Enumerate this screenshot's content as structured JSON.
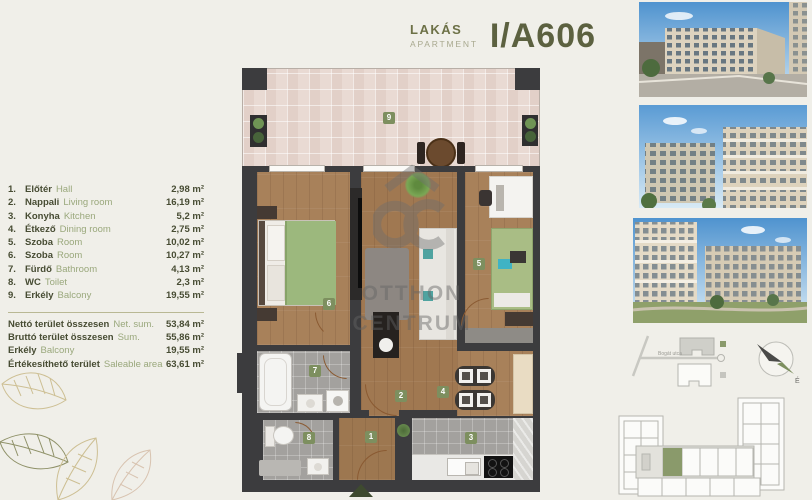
{
  "header": {
    "label_hu": "LAKÁS",
    "label_en": "APARTMENT",
    "unit": "I/A606"
  },
  "legend": {
    "rooms": [
      {
        "num": "1.",
        "name_hu": "Előtér",
        "name_en": "Hall",
        "area": "2,98 m²"
      },
      {
        "num": "2.",
        "name_hu": "Nappali",
        "name_en": "Living room",
        "area": "16,19 m²"
      },
      {
        "num": "3.",
        "name_hu": "Konyha",
        "name_en": "Kitchen",
        "area": "5,2 m²"
      },
      {
        "num": "4.",
        "name_hu": "Étkező",
        "name_en": "Dining room",
        "area": "2,75 m²"
      },
      {
        "num": "5.",
        "name_hu": "Szoba",
        "name_en": "Room",
        "area": "10,02 m²"
      },
      {
        "num": "6.",
        "name_hu": "Szoba",
        "name_en": "Room",
        "area": "10,27 m²"
      },
      {
        "num": "7.",
        "name_hu": "Fürdő",
        "name_en": "Bathroom",
        "area": "4,13 m²"
      },
      {
        "num": "8.",
        "name_hu": "WC",
        "name_en": "Toilet",
        "area": "2,3 m²"
      },
      {
        "num": "9.",
        "name_hu": "Erkély",
        "name_en": "Balcony",
        "area": "19,55 m²"
      }
    ],
    "totals": [
      {
        "name_hu": "Nettó terület összesen",
        "name_en": "Net. sum.",
        "area": "53,84 m²"
      },
      {
        "name_hu": "Bruttó terület összesen",
        "name_en": "Sum.",
        "area": "55,86 m²"
      },
      {
        "name_hu": "Erkély",
        "name_en": "Balcony",
        "area": "19,55 m²"
      },
      {
        "name_hu": "Értékesíthető terület",
        "name_en": "Saleable area",
        "area": "63,61 m²"
      }
    ]
  },
  "plan": {
    "badges": {
      "hall": "1",
      "living": "2",
      "kitchen": "3",
      "dining": "4",
      "room_a": "5",
      "room_b": "6",
      "bathroom": "7",
      "wc": "8",
      "balcony": "9"
    },
    "watermark": {
      "line1": "OTTHON",
      "line2": "CENTRUM"
    }
  },
  "sitemap": {
    "street": "Bogát utca"
  },
  "compass": {
    "label": "É"
  },
  "colors": {
    "accent": "#7d8f5f",
    "wall": "#3c3c3e",
    "text_dark": "#474c33",
    "text_muted": "#9aa87c",
    "wood": "#a8815a",
    "tile": "#e9dad3"
  }
}
